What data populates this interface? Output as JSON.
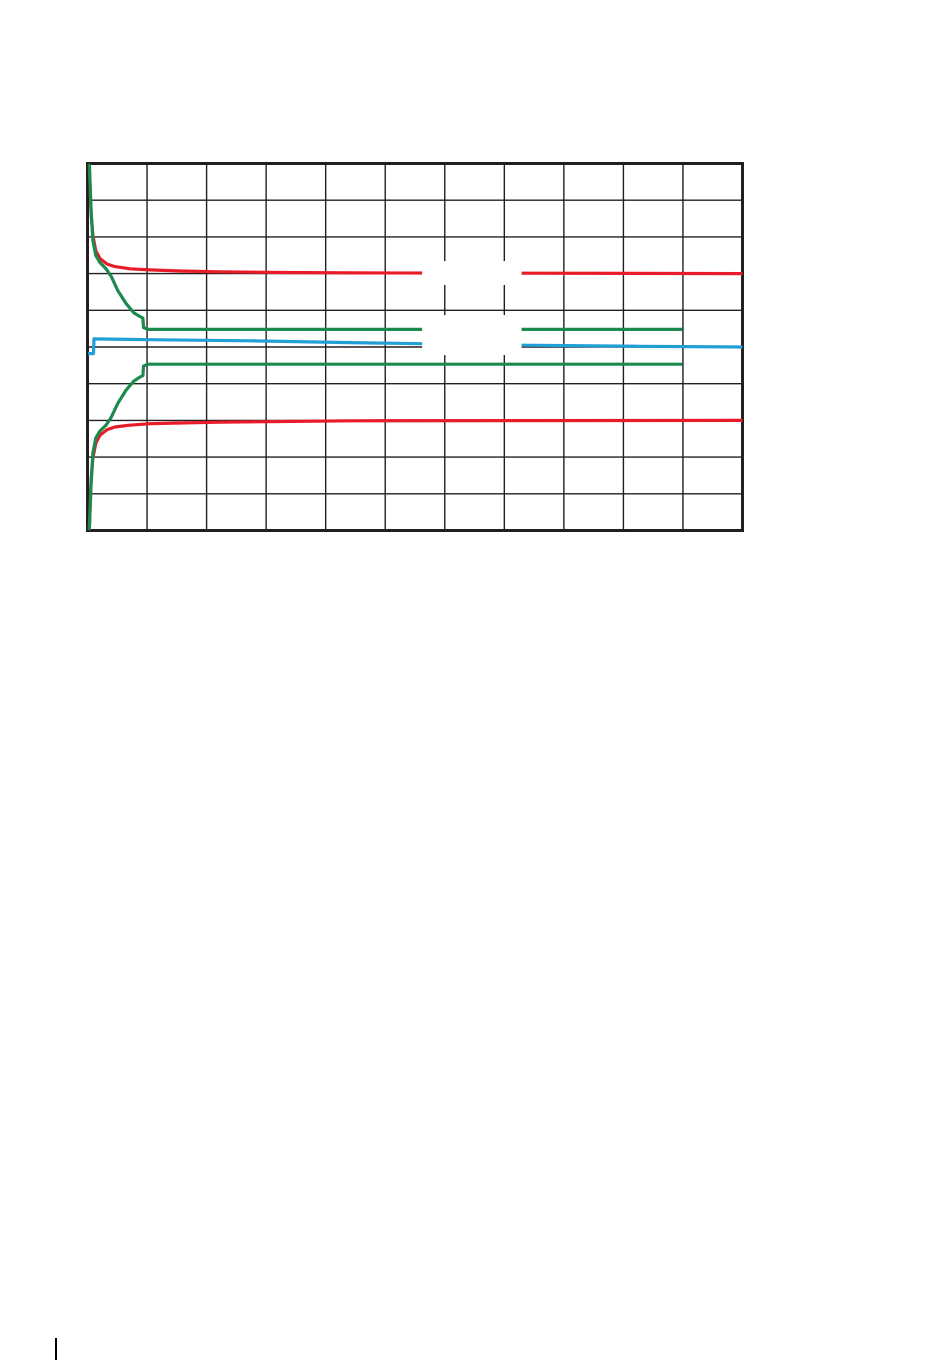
{
  "page": {
    "background_color": "#ffffff",
    "corner_mark": {
      "x": 55,
      "y": 1338,
      "width": 2,
      "height": 22,
      "color": "#000000"
    }
  },
  "chart_data": {
    "type": "line",
    "title": "",
    "subtitle": "",
    "axes_labeled": false,
    "legend_visible": false,
    "x_axis": {
      "range_divisions": [
        0,
        11
      ],
      "tick_labels_visible": false
    },
    "y_axis": {
      "range_divisions": [
        0,
        10
      ],
      "tick_labels_visible": false
    },
    "grid": {
      "columns": 11,
      "rows": 10,
      "color": "#231f20",
      "inner_line_width": 1.4,
      "border_width": 3
    },
    "plot_area_px": {
      "left": 87.5,
      "top": 163.5,
      "right": 742.5,
      "bottom": 530.5
    },
    "series": [
      {
        "name": "red-upper",
        "color": "#e81c28",
        "stroke_width": 3.2,
        "points": [
          [
            0.03,
            9.99
          ],
          [
            0.06,
            8.63
          ],
          [
            0.09,
            8.03
          ],
          [
            0.14,
            7.62
          ],
          [
            0.21,
            7.41
          ],
          [
            0.33,
            7.26
          ],
          [
            0.46,
            7.19
          ],
          [
            0.71,
            7.13
          ],
          [
            1.05,
            7.1
          ],
          [
            1.55,
            7.07
          ],
          [
            2.23,
            7.05
          ],
          [
            3.24,
            7.03
          ],
          [
            4.41,
            7.02
          ],
          [
            7.3,
            7.01
          ],
          [
            11,
            7.0
          ]
        ]
      },
      {
        "name": "red-lower",
        "color": "#e81c28",
        "stroke_width": 3.2,
        "points": [
          [
            0.03,
            0.01
          ],
          [
            0.06,
            1.38
          ],
          [
            0.09,
            1.98
          ],
          [
            0.14,
            2.38
          ],
          [
            0.21,
            2.6
          ],
          [
            0.33,
            2.75
          ],
          [
            0.46,
            2.82
          ],
          [
            0.71,
            2.87
          ],
          [
            1.05,
            2.91
          ],
          [
            1.55,
            2.93
          ],
          [
            2.23,
            2.95
          ],
          [
            3.24,
            2.97
          ],
          [
            4.41,
            2.99
          ],
          [
            11,
            3.0
          ]
        ]
      },
      {
        "name": "green-upper",
        "color": "#1c8a4c",
        "stroke_width": 3.2,
        "points": [
          [
            0.03,
            9.99
          ],
          [
            0.06,
            8.71
          ],
          [
            0.09,
            7.9
          ],
          [
            0.14,
            7.49
          ],
          [
            0.21,
            7.3
          ],
          [
            0.31,
            7.13
          ],
          [
            0.4,
            6.92
          ],
          [
            0.51,
            6.53
          ],
          [
            0.65,
            6.18
          ],
          [
            0.78,
            5.93
          ],
          [
            0.88,
            5.83
          ],
          [
            0.93,
            5.79
          ],
          [
            0.94,
            5.53
          ],
          [
            1.02,
            5.48
          ],
          [
            9.99,
            5.48
          ]
        ]
      },
      {
        "name": "green-lower",
        "color": "#1c8a4c",
        "stroke_width": 3.2,
        "points": [
          [
            0.03,
            0.01
          ],
          [
            0.06,
            1.29
          ],
          [
            0.09,
            2.11
          ],
          [
            0.14,
            2.52
          ],
          [
            0.21,
            2.71
          ],
          [
            0.31,
            2.87
          ],
          [
            0.4,
            3.09
          ],
          [
            0.51,
            3.47
          ],
          [
            0.65,
            3.83
          ],
          [
            0.78,
            4.07
          ],
          [
            0.88,
            4.18
          ],
          [
            0.93,
            4.22
          ],
          [
            0.94,
            4.48
          ],
          [
            1.02,
            4.53
          ],
          [
            9.99,
            4.53
          ]
        ]
      },
      {
        "name": "blue",
        "color": "#219fd7",
        "stroke_width": 3.2,
        "points": [
          [
            0.01,
            4.82
          ],
          [
            0.1,
            4.82
          ],
          [
            0.11,
            5.22
          ],
          [
            1.05,
            5.2
          ],
          [
            2.73,
            5.17
          ],
          [
            4.41,
            5.12
          ],
          [
            5.59,
            5.09
          ],
          [
            7.29,
            5.05
          ],
          [
            9.28,
            5.02
          ],
          [
            11,
            5.0
          ]
        ]
      }
    ],
    "label_gaps": [
      {
        "x1": 5.62,
        "x2": 7.29,
        "y1": 6.69,
        "y2": 7.34
      },
      {
        "x1": 5.62,
        "x2": 7.29,
        "y1": 4.78,
        "y2": 5.87
      }
    ]
  }
}
